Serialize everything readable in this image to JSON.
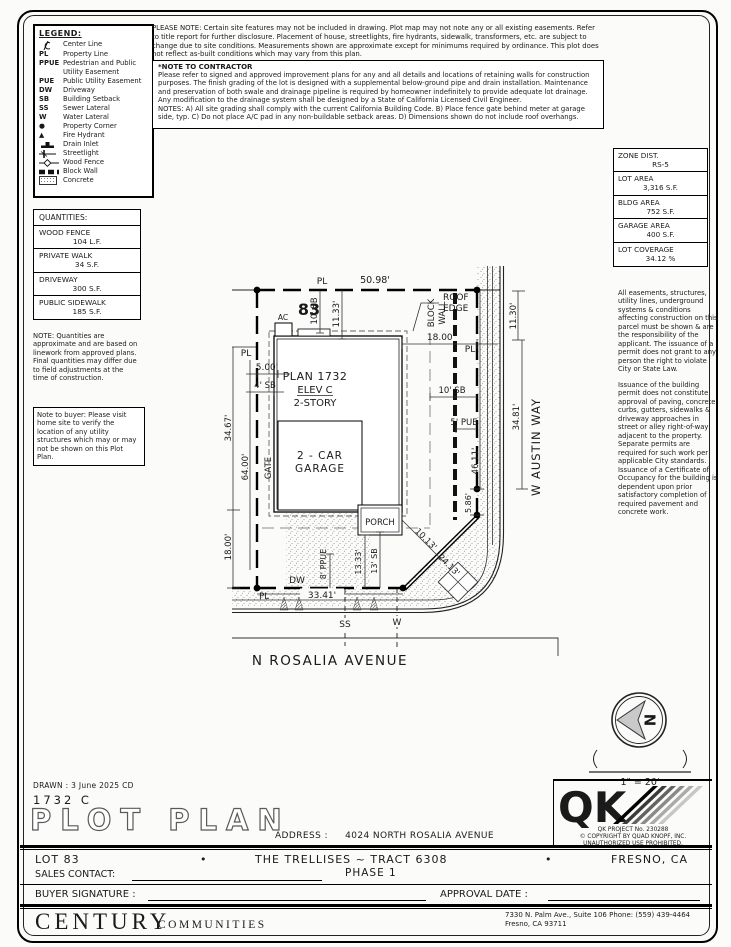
{
  "legend": {
    "title": "LEGEND:",
    "items": [
      {
        "sym": "",
        "label": "Center Line"
      },
      {
        "sym": "PL",
        "label": "Property Line"
      },
      {
        "sym": "PPUE",
        "label": "Pedestrian and Public Utility Easement"
      },
      {
        "sym": "PUE",
        "label": "Public Utility Easement"
      },
      {
        "sym": "DW",
        "label": "Driveway"
      },
      {
        "sym": "SB",
        "label": "Building Setback"
      },
      {
        "sym": "SS",
        "label": "Sewer Lateral"
      },
      {
        "sym": "W",
        "label": "Water Lateral"
      },
      {
        "sym": "●",
        "label": "Property Corner"
      },
      {
        "sym": "▲",
        "label": "Fire Hydrant"
      },
      {
        "sym": "",
        "label": "Drain Inlet"
      },
      {
        "sym": "",
        "label": "Streetlight"
      },
      {
        "sym": "",
        "label": "Wood Fence"
      },
      {
        "sym": "",
        "label": "Block Wall"
      },
      {
        "sym": "",
        "label": "Concrete"
      }
    ]
  },
  "notes": {
    "please_note": "PLEASE NOTE:  Certain site features may not be included in drawing.  Plot map may not note any or all existing easements.  Refer to title report for further disclosure.  Placement of house, streetlights, fire hydrants, sidewalk, transformers, etc. are subject to change due to site conditions.  Measurements shown are approximate except for minimums required by ordinance.  This plot does not reflect as-built conditions which may vary from this plan.",
    "contractor_title": "*NOTE TO CONTRACTOR",
    "contractor_body": "Please refer to signed and approved improvement plans for any and all details and locations of retaining walls for construction purposes. The finish grading of the lot is designed with a supplemental below-ground pipe and drain installation.  Maintenance and preservation of both swale and drainage pipeline is required by homeowner indefinitely to provide adequate lot drainage.  Any modification to the drainage system shall be designed by a State of California Licensed Civil Engineer.",
    "contractor_notes": "NOTES:  A) All site grading shall comply with the current California Building Code.  B) Place fence gate behind meter at garage side, typ.  C) Do not place A/C pad in any non-buildable setback areas.  D) Dimensions shown do not include roof overhangs."
  },
  "site_stats": {
    "items": [
      {
        "label": "ZONE DIST.",
        "value": "RS-5"
      },
      {
        "label": "LOT AREA",
        "value": "3,316 S.F."
      },
      {
        "label": "BLDG AREA",
        "value": "752 S.F."
      },
      {
        "label": "GARAGE AREA",
        "value": "400 S.F."
      },
      {
        "label": "LOT COVERAGE",
        "value": "34.12 %"
      }
    ]
  },
  "right_notes": {
    "p1": "All easements, structures, utility lines, underground systems & conditions affecting construction on this parcel must be shown & are the responsibility of the applicant. The issuance of a permit does not grant to any person the right to violate City or State Law.",
    "p2": "Issuance of the building permit does not constitute approval of paving, concrete curbs, gutters, sidewalks & driveway approaches in street or alley right-of-way adjacent to the property. Separate permits are required for such work per applicable City standards. Issuance of a Certificate of Occupancy for the building is dependent upon prior satisfactory completion of required pavement and concrete work."
  },
  "quantities": {
    "title": "QUANTITIES:",
    "items": [
      {
        "label": "WOOD FENCE",
        "value": "104 L.F."
      },
      {
        "label": "PRIVATE WALK",
        "value": "34 S.F."
      },
      {
        "label": "DRIVEWAY",
        "value": "300 S.F."
      },
      {
        "label": "PUBLIC SIDEWALK",
        "value": "185 S.F."
      }
    ],
    "note": "NOTE: Quantities are approximate and are based on linework from approved plans.  Final quantities may differ due to field adjustments at the time of construction.",
    "buyer_note": "Note to buyer: Please visit home site to verify the location of any utility structures which may or may not be shown on this Plot Plan."
  },
  "plot": {
    "pl": "PL",
    "dim_frontage": "50.98'",
    "lot_number": "83",
    "ac": "AC",
    "sb10": "10' SB",
    "dim_1133": "11.33'",
    "roof1": "ROOF",
    "roof2": "EDGE",
    "bw1": "BLOCK",
    "bw2": "WALL",
    "dim_18": "18.00'",
    "dim_5": "5.00'",
    "sb4": "4' SB",
    "plan": "PLAN 1732",
    "elev": "ELEV C",
    "story": "2-STORY",
    "pue5": "5' PUE",
    "dim_3467": "34.67'",
    "dim_64": "64.00'",
    "gate": "GATE",
    "gar1": "2 - CAR",
    "gar2": "GARAGE",
    "dim_4611": "46.11'",
    "dim_3481": "34.81'",
    "dim_1130": "11.30'",
    "dim_586": "5.86'",
    "porch": "PORCH",
    "dim_1013": "10.13'",
    "dim_2413": "24.13'",
    "dw": "DW",
    "dim_3341": "33.41'",
    "ppue8": "8' PPUE",
    "dim_1333": "13.33'",
    "sb13": "13' SB",
    "ss": "SS",
    "w": "W",
    "street_s": "N ROSALIA AVENUE",
    "street_e": "W AUSTIN WAY",
    "north": "N"
  },
  "compass": {
    "scale": "1\" = 20'"
  },
  "qk": {
    "project": "QK PROJECT No. 230288",
    "copyright": "©  COPYRIGHT BY QUAD KNOPF, INC.",
    "prohibited": "UNAUTHORIZED USE PROHIBITED."
  },
  "titleblock": {
    "drawn": "DRAWN :  3 June 2025  CD",
    "plan_code": "1732  C",
    "title": "PLOT PLAN",
    "address_label": "ADDRESS :",
    "address": "4024 NORTH ROSALIA AVENUE",
    "lot": "LOT 83",
    "bullet": "•",
    "tract": "THE TRELLISES ~ TRACT 6308",
    "phase": "PHASE 1",
    "city": "FRESNO, CA",
    "sales_contact_label": "SALES CONTACT:",
    "buyer_sig_label": "BUYER SIGNATURE :",
    "approval_label": "APPROVAL DATE :"
  },
  "footer": {
    "brand": "CENTURY",
    "brand2": "COMMUNITIES",
    "address1": "7330 N. Palm Ave., Suite 106    Phone:  (559) 439-4464",
    "address2": "Fresno, CA  93711"
  }
}
